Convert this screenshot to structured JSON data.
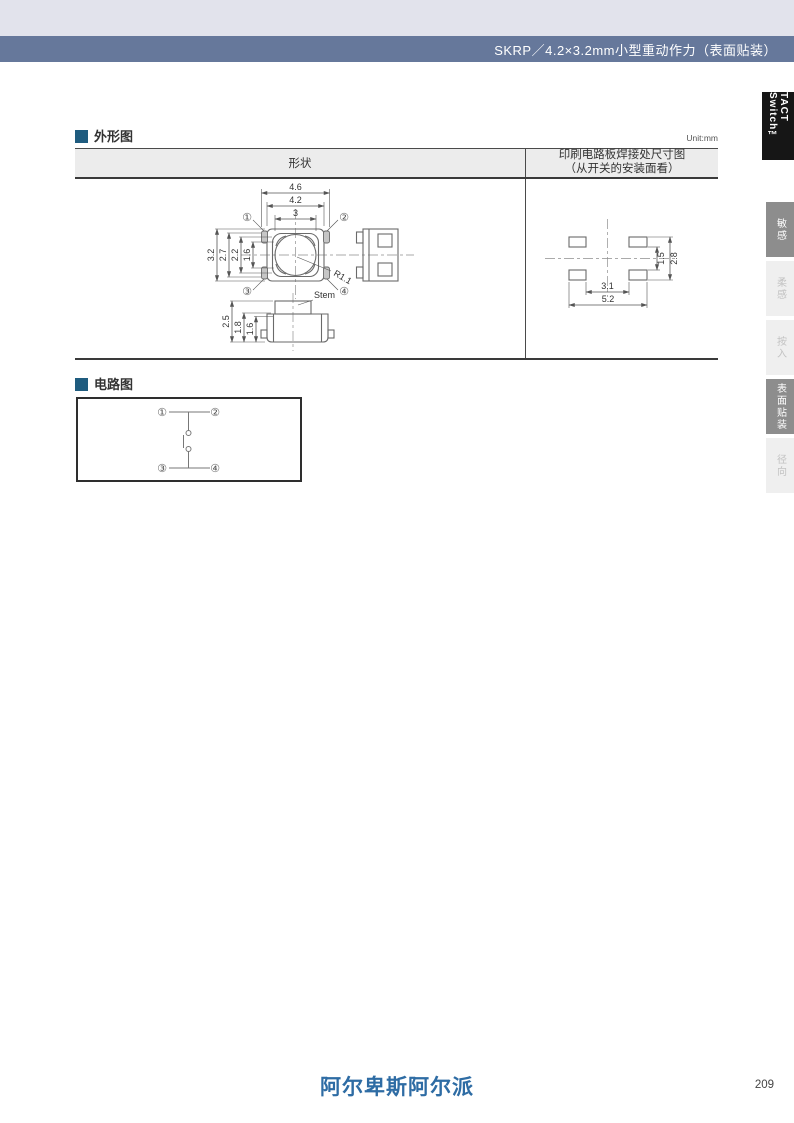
{
  "header": {
    "title": "SKRP／4.2×3.2mm小型重动作力（表面贴装）"
  },
  "sidebar": {
    "series_tab": "TACT Switch™",
    "tabs": [
      {
        "label": "敏感",
        "active": true
      },
      {
        "label": "柔感",
        "active": false
      },
      {
        "label": "按入",
        "active": false
      },
      {
        "label": "表面贴装",
        "active": true
      },
      {
        "label": "径向",
        "active": false
      }
    ]
  },
  "outline": {
    "title": "外形图",
    "unit": "Unit:mm",
    "columns": {
      "shape": "形状",
      "pcb_line1": "印刷电路板焊接处尺寸图",
      "pcb_line2": "（从开关的安装面看）"
    },
    "top_view": {
      "dim_w1": "4.6",
      "dim_w2": "4.2",
      "dim_w3": "3",
      "dim_h1": "3.2",
      "dim_h2": "2.7",
      "dim_h3": "2.2",
      "dim_h4": "1.6",
      "radius": "R1.1",
      "t1": "①",
      "t2": "②",
      "t3": "③",
      "t4": "④"
    },
    "front_view": {
      "stem": "Stem",
      "dim_h1": "2.5",
      "dim_h2": "1.8",
      "dim_h3": "1.6"
    },
    "pcb_view": {
      "dim_inner_w": "3.1",
      "dim_outer_w": "5.2",
      "dim_inner_h": "1.5",
      "dim_outer_h": "2.8"
    }
  },
  "circuit": {
    "title": "电路图",
    "t1": "①",
    "t2": "②",
    "t3": "③",
    "t4": "④"
  },
  "footer": {
    "logo": "阿尔卑斯阿尔派",
    "page": "209"
  },
  "colors": {
    "top_band": "#e2e3ec",
    "header_bar": "#66789b",
    "section_bullet": "#1f5c7f",
    "logo_blue": "#2e6ca4",
    "tab_active_bg": "#8d8d8d",
    "tab_inactive_bg": "#efefef",
    "tact_box_bg": "#161616"
  }
}
